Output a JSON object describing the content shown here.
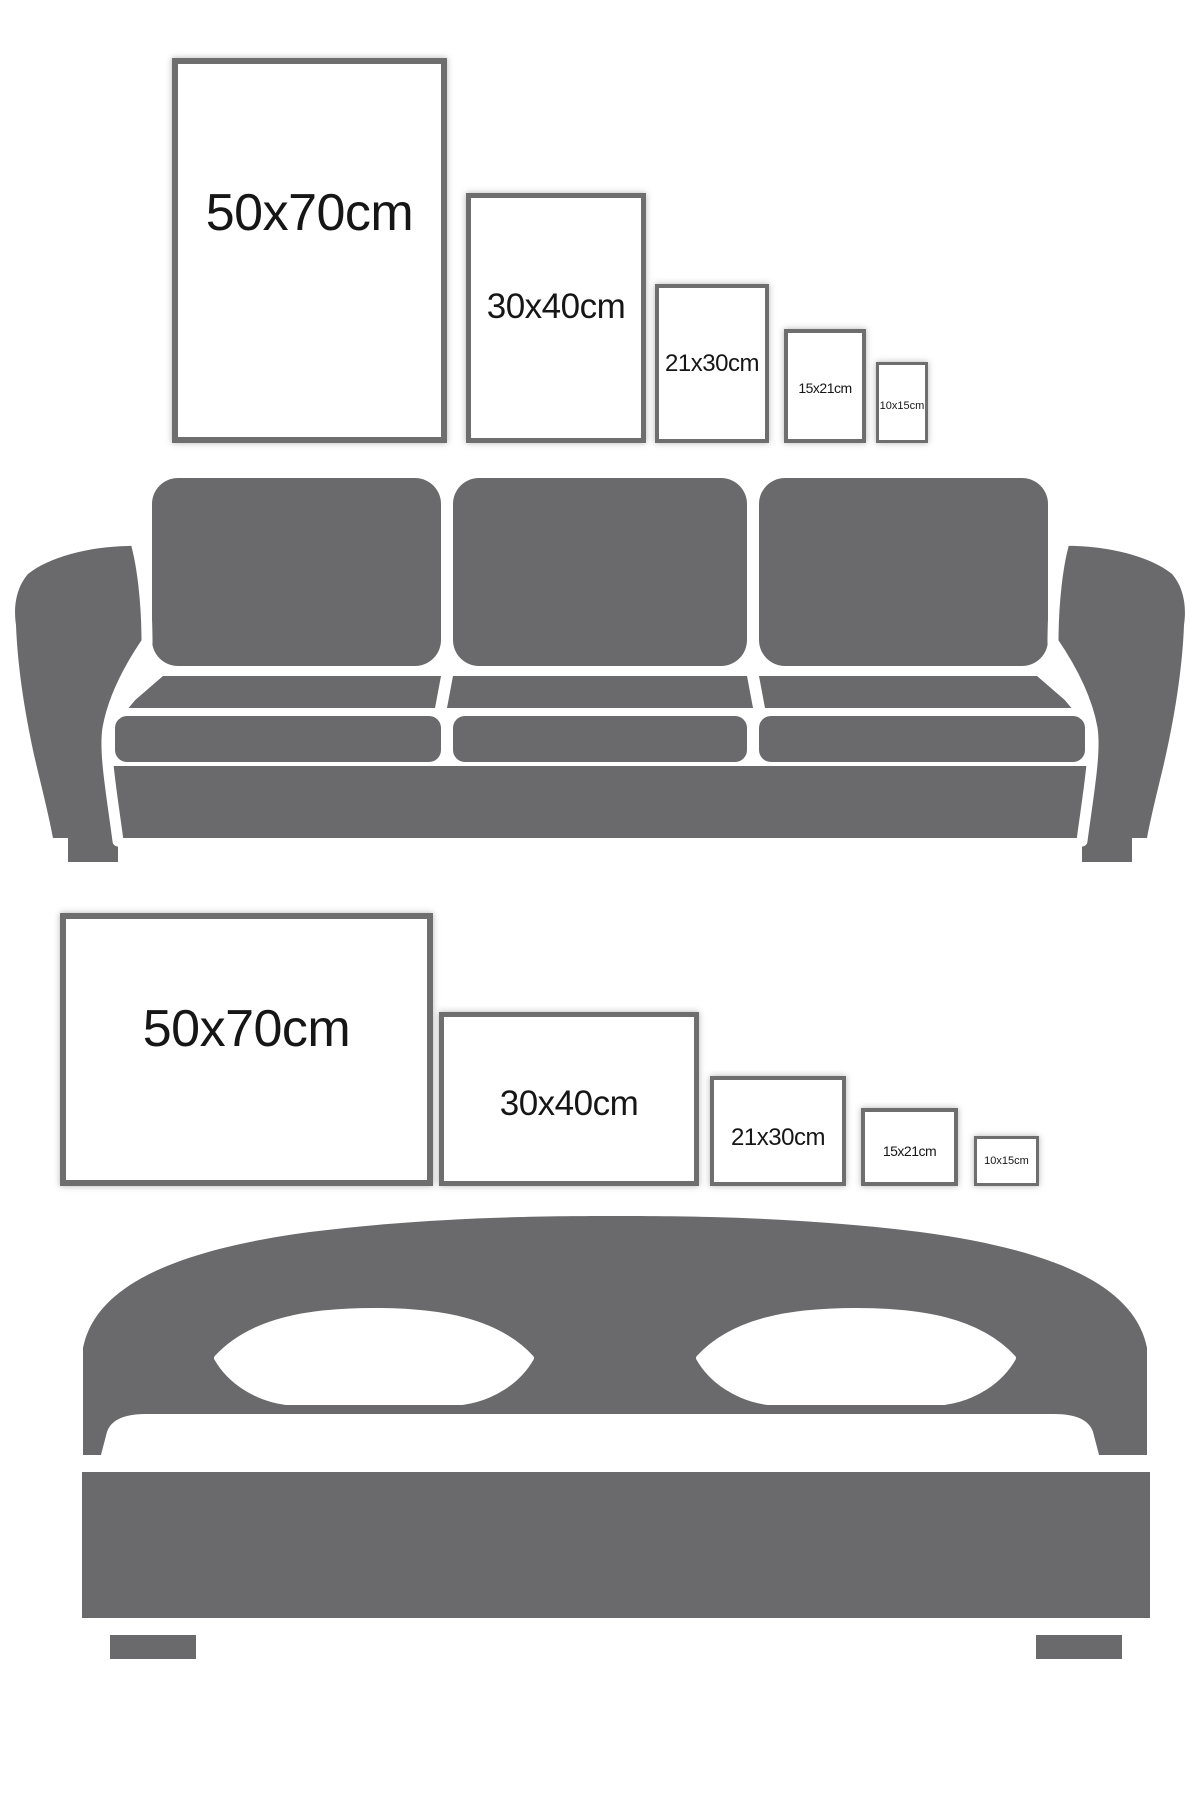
{
  "page": {
    "title": "Frame size comparison on wall above furniture"
  },
  "colors": {
    "furniture-gray": "#6a6a6c",
    "frame-border": "#6e6e6e",
    "label-color": "#161616",
    "background": "#ffffff"
  },
  "portrait_group": {
    "furniture": "sofa-icon",
    "orientation": "portrait",
    "frames": [
      {
        "label": "50x70cm",
        "width_cm": 50,
        "height_cm": 70
      },
      {
        "label": "30x40cm",
        "width_cm": 30,
        "height_cm": 40
      },
      {
        "label": "21x30cm",
        "width_cm": 21,
        "height_cm": 30
      },
      {
        "label": "15x21cm",
        "width_cm": 15,
        "height_cm": 21
      },
      {
        "label": "10x15cm",
        "width_cm": 10,
        "height_cm": 15
      }
    ]
  },
  "landscape_group": {
    "furniture": "bed-icon",
    "orientation": "landscape",
    "frames": [
      {
        "label": "50x70cm",
        "width_cm": 70,
        "height_cm": 50
      },
      {
        "label": "30x40cm",
        "width_cm": 40,
        "height_cm": 30
      },
      {
        "label": "21x30cm",
        "width_cm": 30,
        "height_cm": 21
      },
      {
        "label": "15x21cm",
        "width_cm": 21,
        "height_cm": 15
      },
      {
        "label": "10x15cm",
        "width_cm": 15,
        "height_cm": 10
      }
    ]
  }
}
